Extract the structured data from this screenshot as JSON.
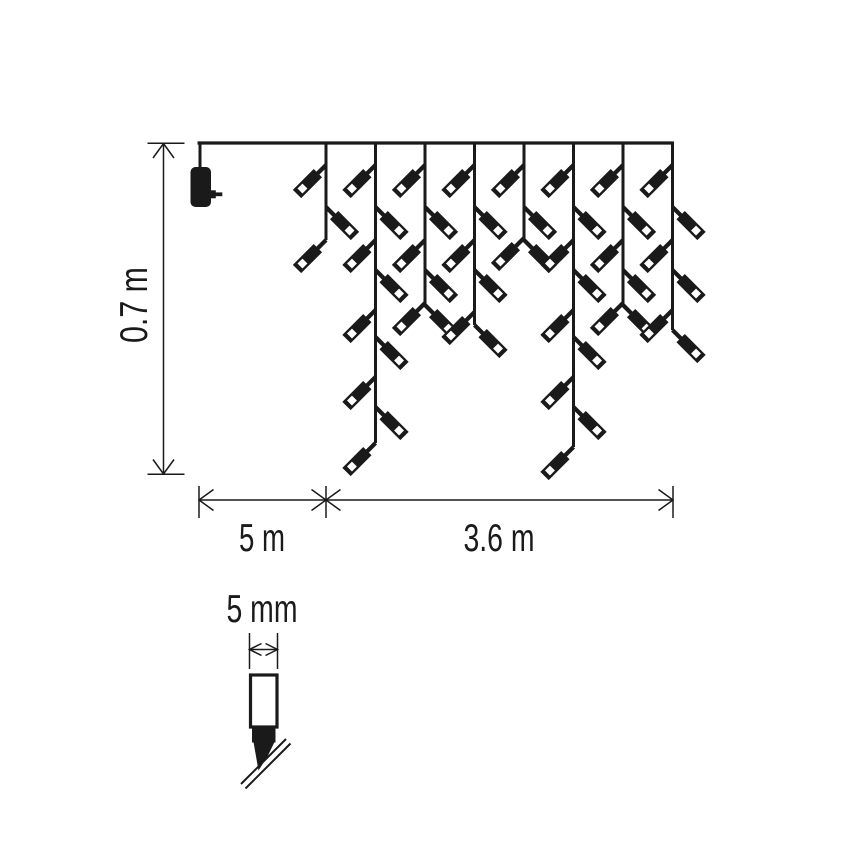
{
  "figure": {
    "kind": "product-dimension-diagram",
    "subject": "icicle-string-lights"
  },
  "colors": {
    "ink": "#1a1a1a",
    "paper": "#ffffff"
  },
  "dimensions": {
    "drop_height": {
      "label": "0.7 m"
    },
    "lead_length": {
      "label": "5 m"
    },
    "lit_length": {
      "label": "3.6 m"
    },
    "bulb_width": {
      "label": "5 mm"
    }
  },
  "curtain": {
    "wire": {
      "x1": 197.5,
      "y": 143,
      "x2": 673
    },
    "adapter": {
      "drop_x": 200,
      "body_x": 190.5,
      "body_y": 167,
      "body_w": 20.5,
      "body_h": 40,
      "body_rx": 5
    },
    "strands": [
      {
        "x": 326,
        "bottom": 240,
        "leds": [
          {
            "side": "L",
            "y": 165
          },
          {
            "side": "R",
            "y": 207
          },
          {
            "side": "L",
            "y": 240
          }
        ]
      },
      {
        "x": 375.5,
        "bottom": 443,
        "leds": [
          {
            "side": "L",
            "y": 165
          },
          {
            "side": "R",
            "y": 207
          },
          {
            "side": "L",
            "y": 240
          },
          {
            "side": "R",
            "y": 270
          },
          {
            "side": "L",
            "y": 310
          },
          {
            "side": "R",
            "y": 337
          },
          {
            "side": "L",
            "y": 377
          },
          {
            "side": "R",
            "y": 407
          },
          {
            "side": "L",
            "y": 443
          }
        ]
      },
      {
        "x": 425,
        "bottom": 305,
        "leds": [
          {
            "side": "L",
            "y": 165
          },
          {
            "side": "R",
            "y": 207
          },
          {
            "side": "L",
            "y": 240
          },
          {
            "side": "R",
            "y": 270
          },
          {
            "side": "L",
            "y": 303
          },
          {
            "side": "R",
            "y": 305
          }
        ]
      },
      {
        "x": 474.5,
        "bottom": 325,
        "leds": [
          {
            "side": "L",
            "y": 165
          },
          {
            "side": "R",
            "y": 207
          },
          {
            "side": "L",
            "y": 240
          },
          {
            "side": "R",
            "y": 270
          },
          {
            "side": "L",
            "y": 312
          },
          {
            "side": "R",
            "y": 325
          }
        ]
      },
      {
        "x": 524,
        "bottom": 240,
        "leds": [
          {
            "side": "L",
            "y": 165
          },
          {
            "side": "R",
            "y": 207
          },
          {
            "side": "L",
            "y": 238
          },
          {
            "side": "R",
            "y": 240
          }
        ]
      },
      {
        "x": 573.5,
        "bottom": 447,
        "leds": [
          {
            "side": "L",
            "y": 165
          },
          {
            "side": "R",
            "y": 207
          },
          {
            "side": "L",
            "y": 240
          },
          {
            "side": "R",
            "y": 270
          },
          {
            "side": "L",
            "y": 310
          },
          {
            "side": "R",
            "y": 337
          },
          {
            "side": "L",
            "y": 377
          },
          {
            "side": "R",
            "y": 407
          },
          {
            "side": "L",
            "y": 447
          }
        ]
      },
      {
        "x": 623,
        "bottom": 305,
        "leds": [
          {
            "side": "L",
            "y": 165
          },
          {
            "side": "R",
            "y": 207
          },
          {
            "side": "L",
            "y": 240
          },
          {
            "side": "R",
            "y": 270
          },
          {
            "side": "L",
            "y": 303
          },
          {
            "side": "R",
            "y": 305
          }
        ]
      },
      {
        "x": 672.5,
        "bottom": 330,
        "leds": [
          {
            "side": "L",
            "y": 165
          },
          {
            "side": "R",
            "y": 207
          },
          {
            "side": "L",
            "y": 240
          },
          {
            "side": "R",
            "y": 270
          },
          {
            "side": "L",
            "y": 310
          },
          {
            "side": "R",
            "y": 330
          }
        ]
      }
    ],
    "led_glyph": {
      "stem_w": 4.2,
      "stem_len": 12,
      "body_w": 11.8,
      "body_len": 29.5,
      "window": 7,
      "window_from_tip": 4.2
    }
  }
}
